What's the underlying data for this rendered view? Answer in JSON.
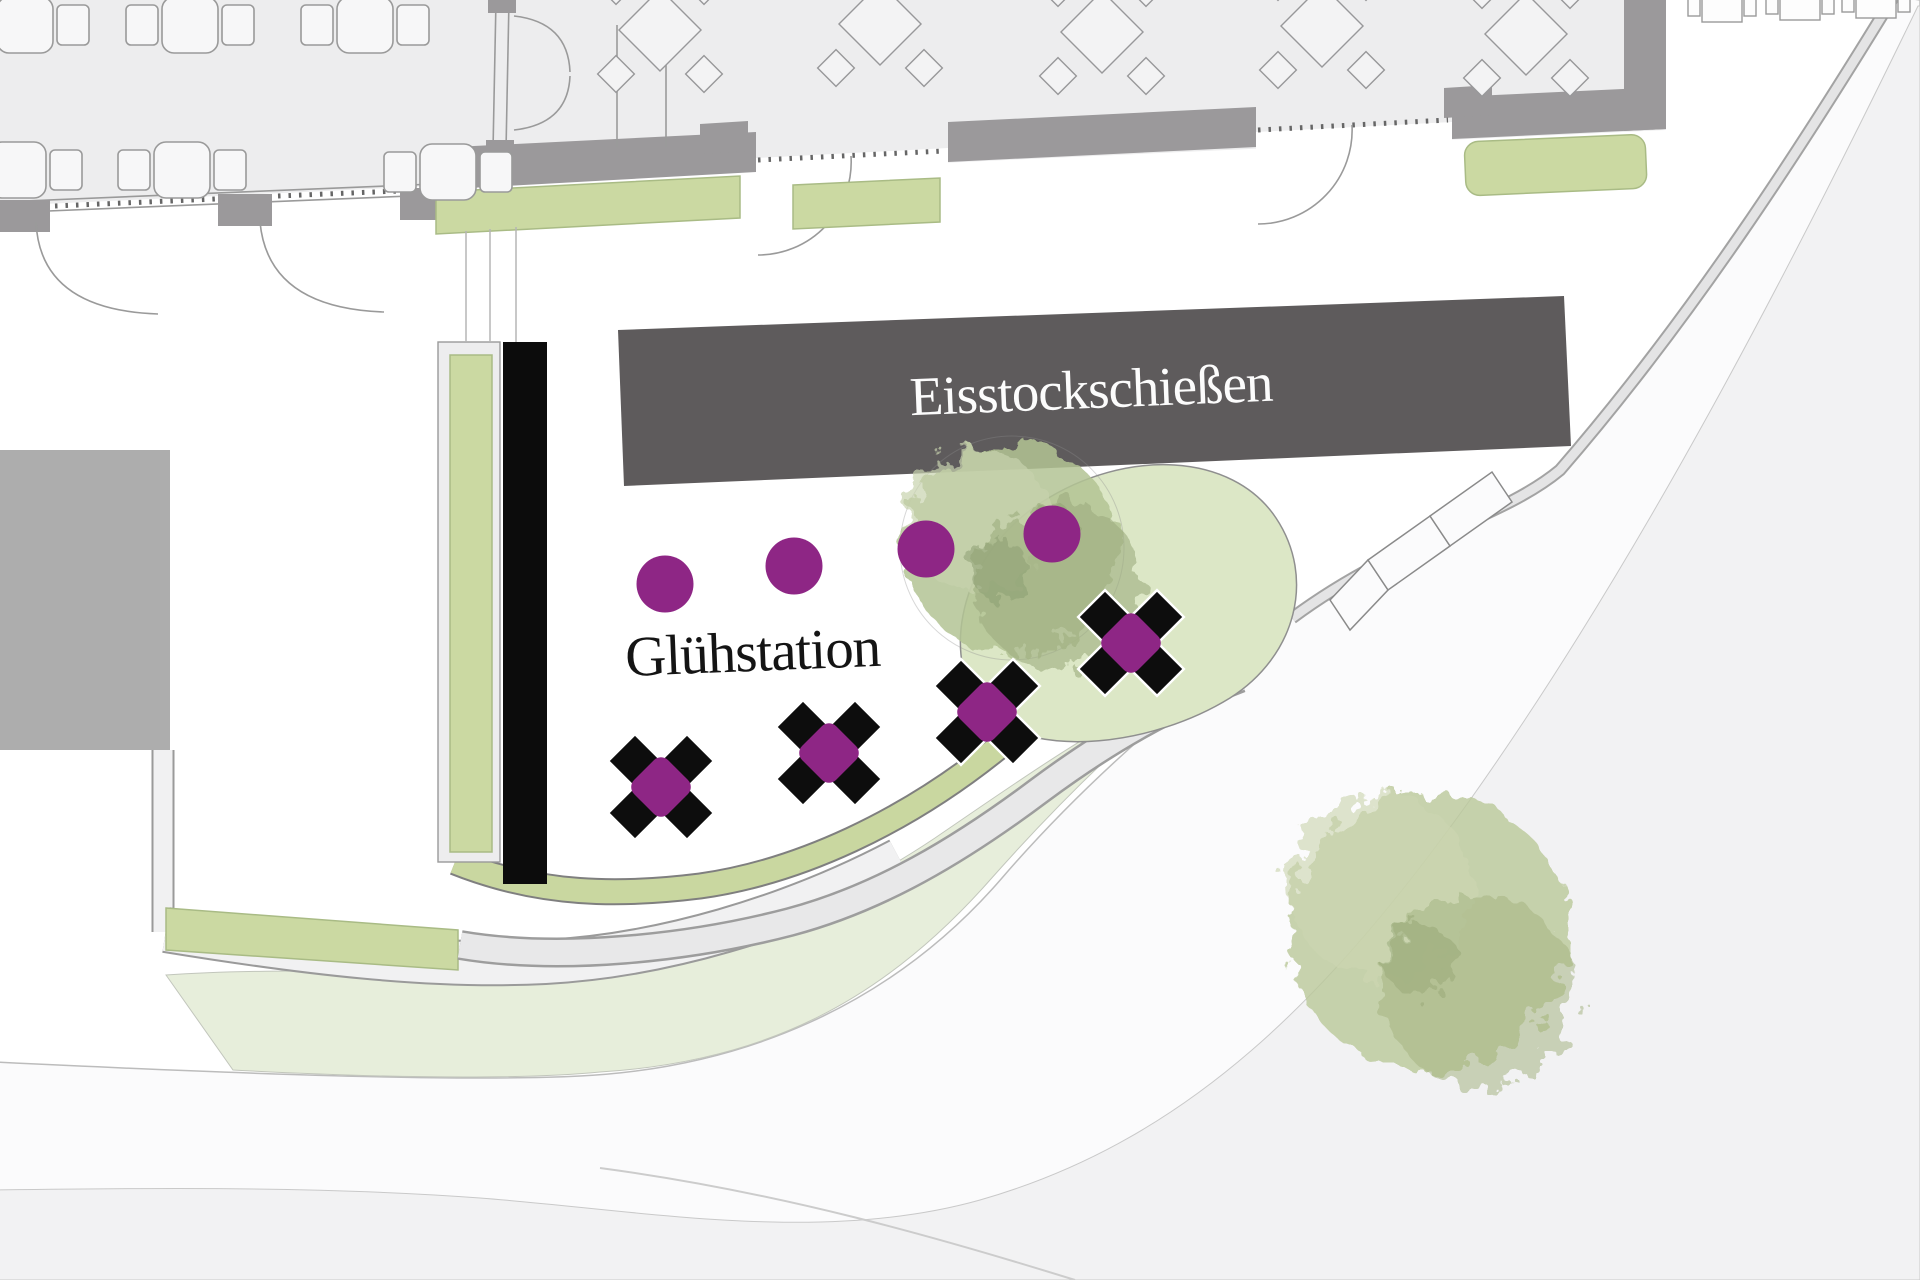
{
  "plan": {
    "rink_label": "Eisstockschießen",
    "station_label": "Glühstation"
  },
  "furniture": {
    "standing_tables": 4,
    "cross_bench_tables": 4,
    "indoor_tables": 6,
    "terrace_parasol_tables": 5,
    "outdoor_mini_tables": 3
  },
  "colors": {
    "accent_purple": "#8e2685",
    "rink_gray": "#5e5b5c",
    "structure_black": "#0c0c0c",
    "wall_gray": "#9b999b",
    "floor_gray": "#ededee",
    "planting_green": "#cbd9a2",
    "hedge_green": "#c9d7a0",
    "lawn_green": "#e7eedb",
    "bed_green": "#dce7c6",
    "road_white": "#fbfbfc",
    "offsite_gray": "#f2f2f3",
    "block_gray": "#adadad",
    "furniture_fill": "#f7f7f8",
    "text_light": "#fcfcfc",
    "text_dark": "#141414"
  }
}
